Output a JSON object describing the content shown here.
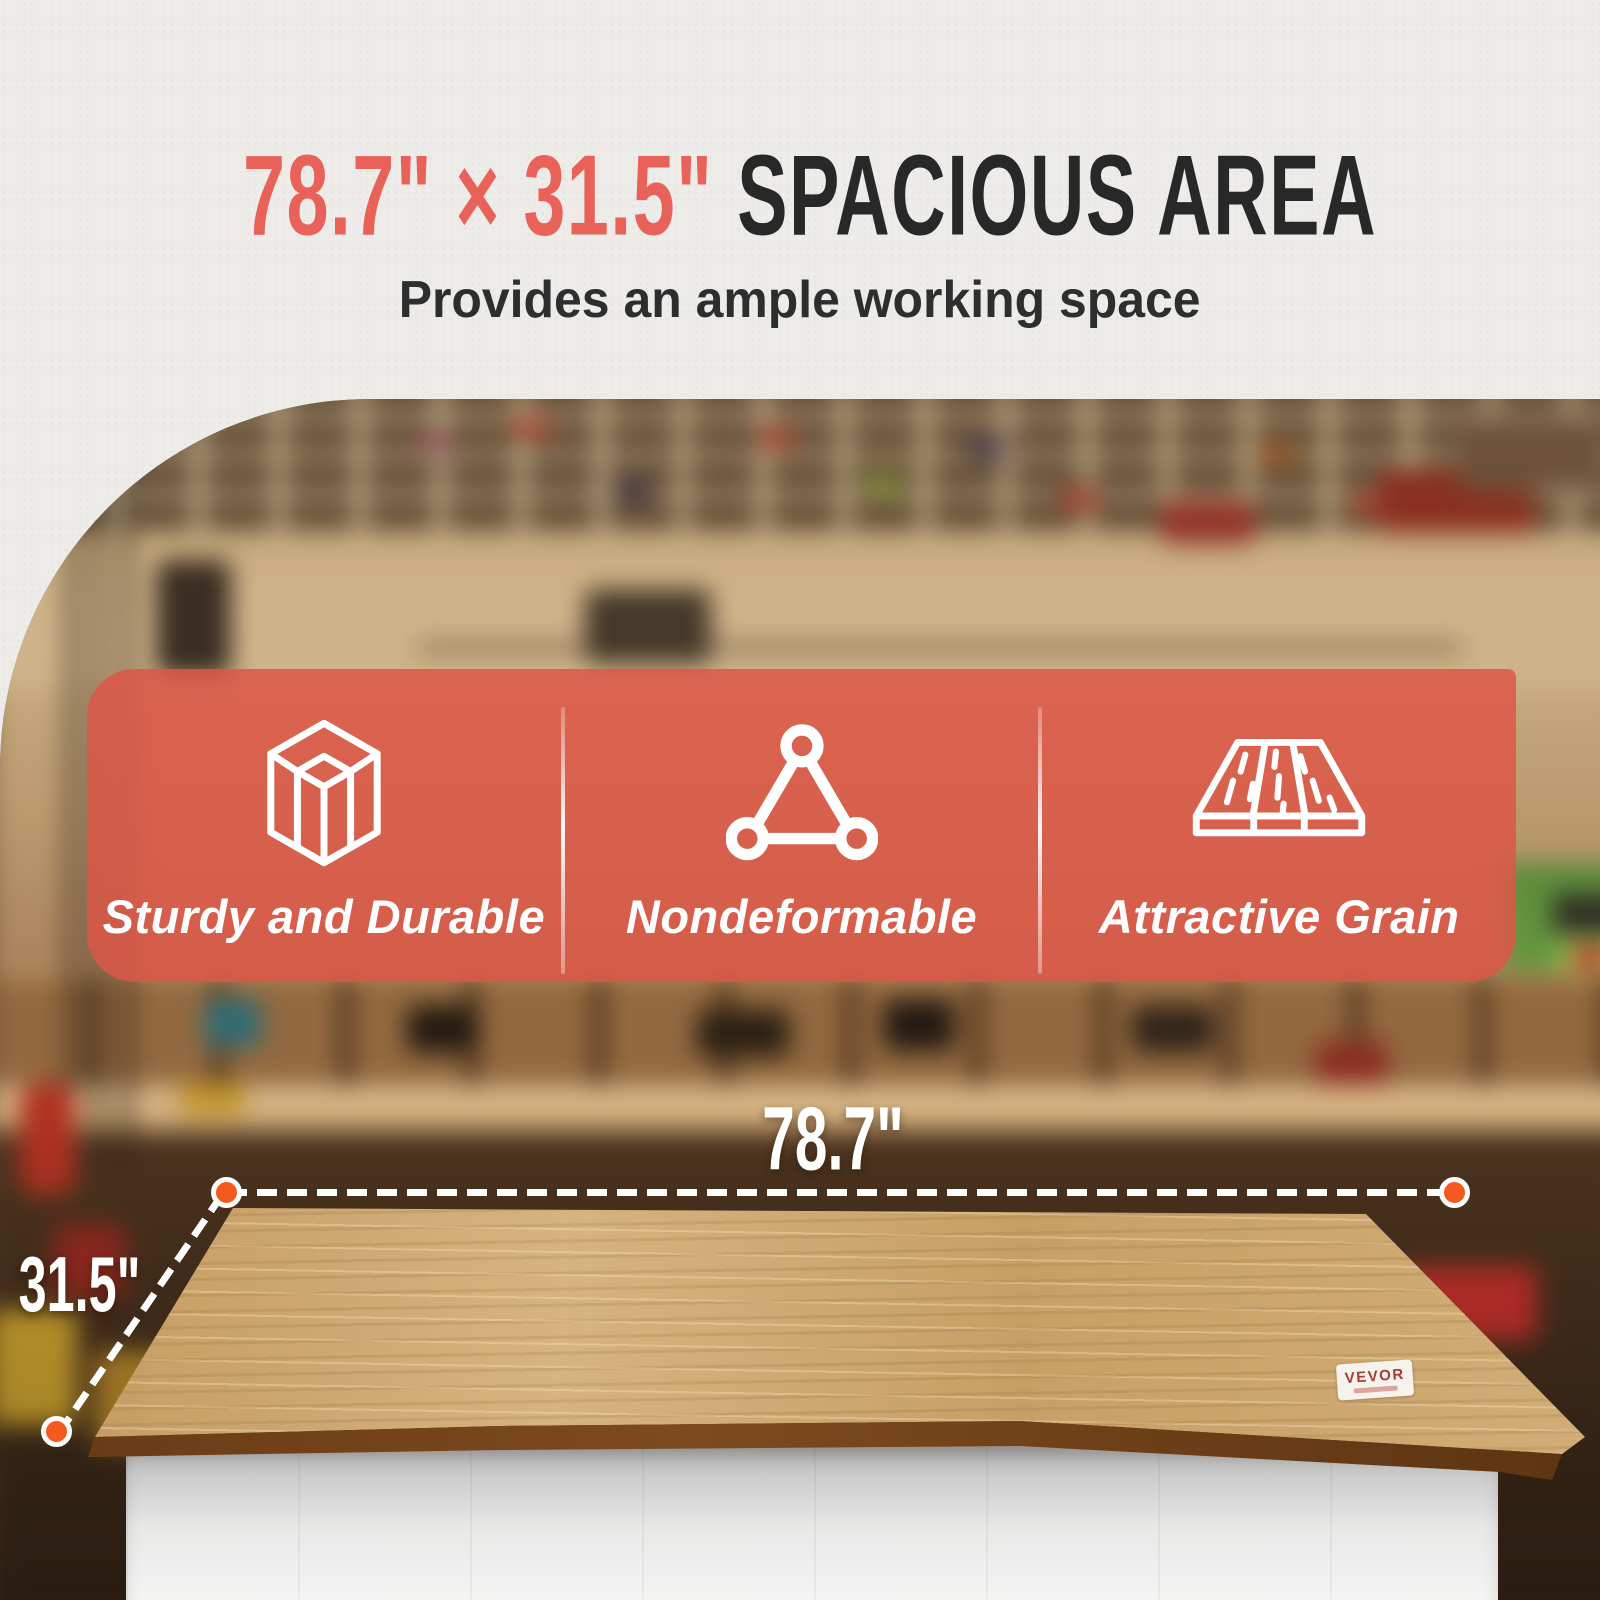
{
  "header": {
    "dimensions": "78.7\" × 31.5\"",
    "title": "SPACIOUS AREA",
    "subtitle": "Provides an ample working space"
  },
  "features": [
    {
      "icon": "cube-wireframe-icon",
      "label": "Sturdy and Durable"
    },
    {
      "icon": "triangle-nodes-icon",
      "label": "Nondeformable"
    },
    {
      "icon": "wood-grain-icon",
      "label": "Attractive Grain"
    }
  ],
  "product": {
    "brand_label": "VEVOR",
    "width_label": "78.7\"",
    "depth_label": "31.5\""
  },
  "colors": {
    "accent_red": "#e8625a",
    "title_dark": "#282828",
    "banner_coral": "rgba(221,85,71,0.83)",
    "dot_orange": "#f45a1f"
  }
}
